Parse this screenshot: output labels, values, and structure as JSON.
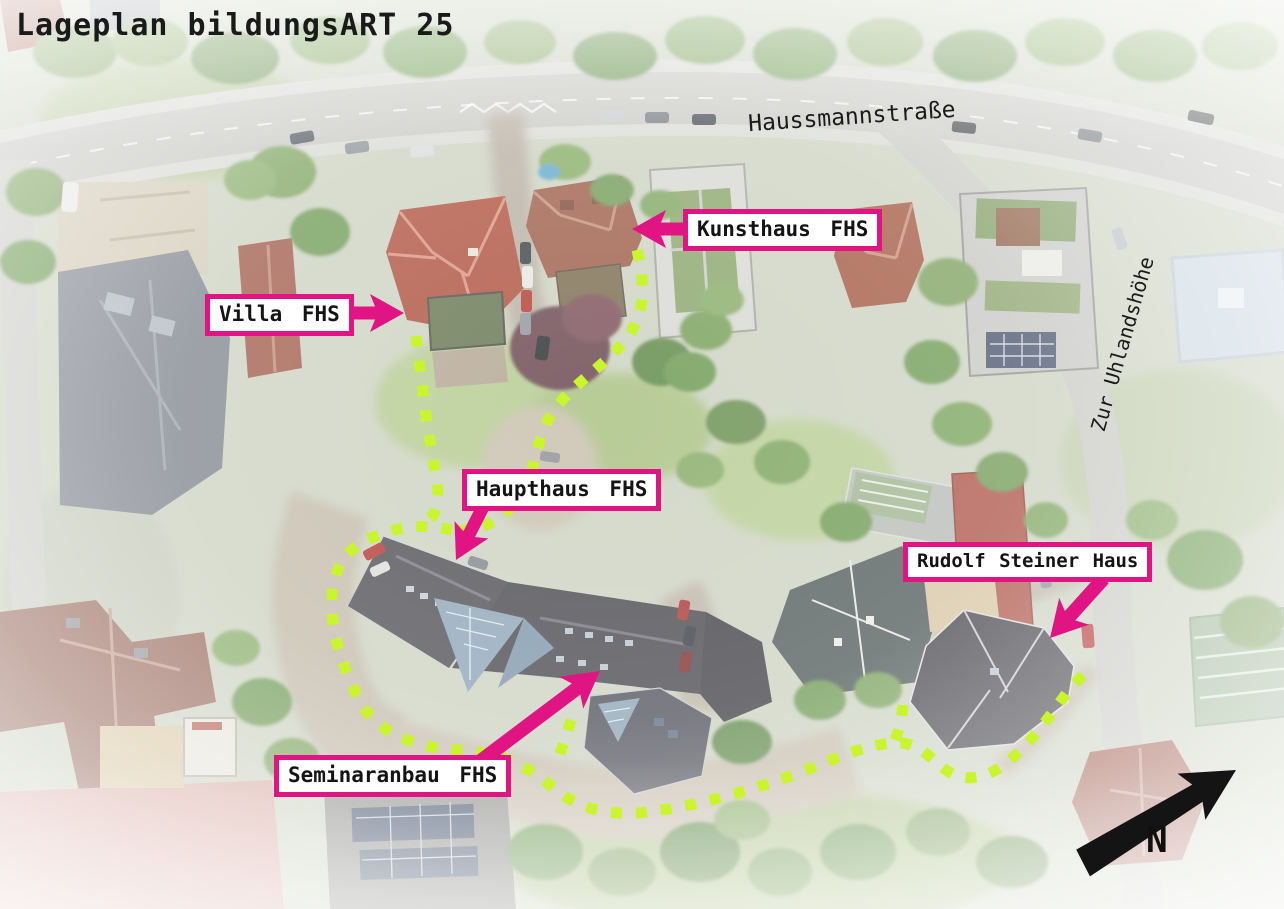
{
  "title": "Lageplan bildungsART 25",
  "streets": [
    {
      "name": "Haussmannstraße"
    },
    {
      "name": "Zur Uhlandshöhe"
    }
  ],
  "labels": [
    {
      "id": "kunsthaus",
      "text": "Kunsthaus FHS"
    },
    {
      "id": "villa",
      "text": "Villa FHS"
    },
    {
      "id": "haupthaus",
      "text": "Haupthaus FHS"
    },
    {
      "id": "rudolf-steiner",
      "text": "Rudolf Steiner Haus"
    },
    {
      "id": "seminaranbau",
      "text": "Seminaranbau FHS"
    }
  ],
  "compass": {
    "label": "N"
  },
  "route": {
    "style": "dotted-square-dashes",
    "color": "#c9f52f"
  },
  "theme": {
    "magenta": "#e01483",
    "route_green": "#c9f52f",
    "label_bg": "#ffffff",
    "label_text": "#141414",
    "title_color": "#1a1a1a",
    "compass_color": "#101010"
  }
}
